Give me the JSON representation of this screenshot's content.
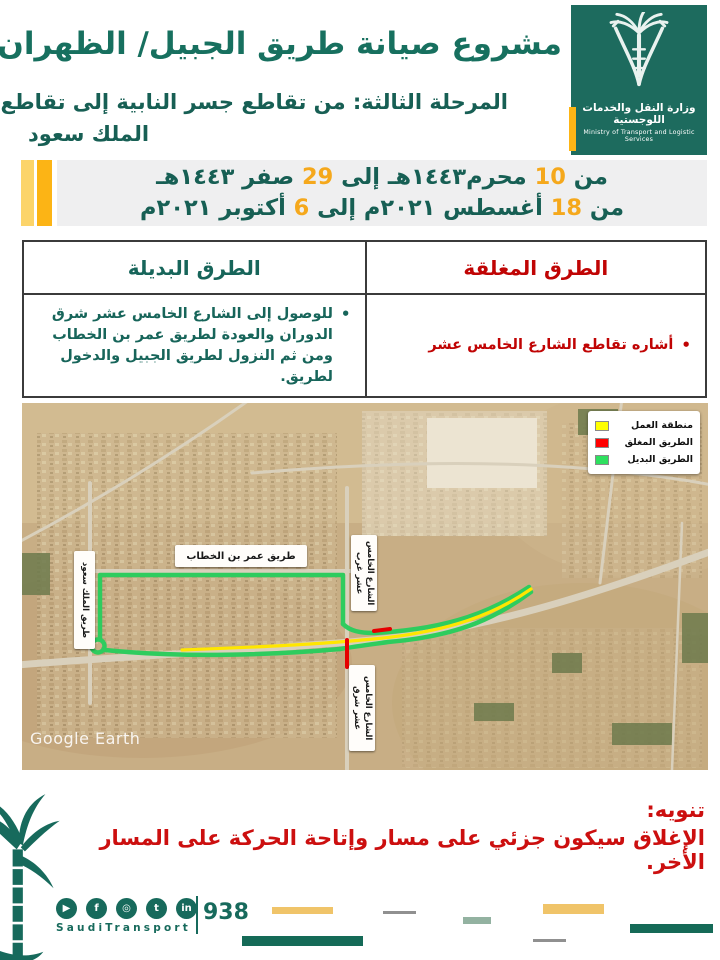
{
  "header": {
    "title": "مشروع صيانة طريق الجبيل/ الظهران",
    "subtitle_line1": "المرحلة الثالثة: من تقاطع جسر النابية إلى تقاطع طريق",
    "subtitle_line2": "الملك سعود",
    "logo": {
      "ministry_ar": "وزارة النقل والخدمات اللوجستية",
      "ministry_en": "Ministry of Transport and Logistic Services"
    }
  },
  "dates": {
    "hijri": {
      "t1": "من ",
      "n1": "10",
      "t2": " محرم١٤٤٣هـ إلى ",
      "n2": "29",
      "t3": " صفر ١٤٤٣هـ"
    },
    "gregorian": {
      "t1": "من ",
      "n1": "18",
      "t2": " أغسطس ٢٠٢١م إلى ",
      "n2": "6",
      "t3": " أكتوبر ٢٠٢١م"
    }
  },
  "table": {
    "closed_header": "الطرق المغلقة",
    "closed_item": "أشاره تقاطع الشارع الخامس عشر",
    "alt_header": "الطرق البديلة",
    "alt_item": "للوصول إلى الشارع الخامس عشر شرق الدوران والعودة لطريق عمر بن الخطاب ومن ثم النزول لطريق الجبيل والدخول لطريق.",
    "bullet": "•"
  },
  "map": {
    "legend": [
      {
        "label": "منطقة العمل",
        "color": "#ffff00"
      },
      {
        "label": "الطريق المغلق",
        "color": "#ff0000"
      },
      {
        "label": "الطريق البديل",
        "color": "#2ee05f"
      }
    ],
    "road_labels": {
      "omar_bin_alkhattab": "طريق عمر بن الخطاب",
      "king_saud": "طريق الملك سعود",
      "fifteenth_west": "الشارع الخامس عشر غرب",
      "fifteenth_east": "الشارع الخامس عشر شرق"
    },
    "watermark": "Google Earth"
  },
  "notice": {
    "title": "تنويه:",
    "body": "الإغلاق سيكون جزئي على مسار وإتاحة الحركة على المسار الأخر."
  },
  "footer": {
    "brand": "SaudiTransport",
    "number": "938",
    "social": [
      {
        "name": "youtube",
        "glyph": "▶"
      },
      {
        "name": "facebook",
        "glyph": "f"
      },
      {
        "name": "instagram",
        "glyph": "◎"
      },
      {
        "name": "twitter",
        "glyph": "t"
      },
      {
        "name": "linkedin",
        "glyph": "in"
      }
    ]
  },
  "colors": {
    "brand_teal": "#1d6b5e",
    "accent_yellow": "#fdb515",
    "light_yellow": "#fcd46a",
    "alert_red": "#c00404",
    "route_green": "#2ecc5e",
    "route_yellow": "#ffe600",
    "route_red": "#e60000"
  }
}
